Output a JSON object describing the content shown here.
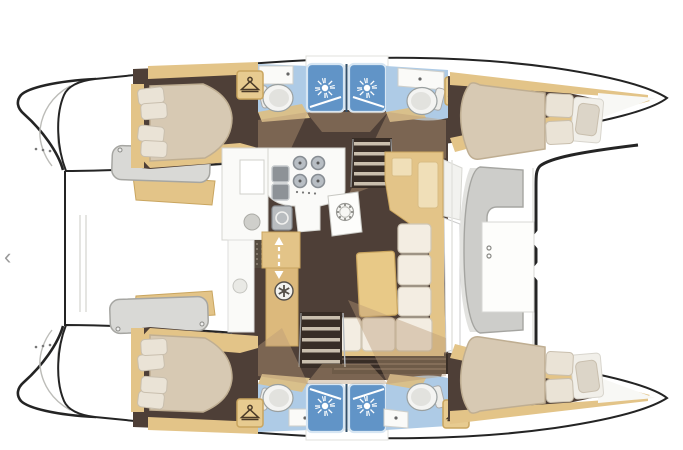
{
  "image": {
    "type": "boat-floor-plan",
    "subject": "catamaran interior deck plan, top-down view, bows to the right"
  },
  "carousel": {
    "prev_glyph": "‹"
  },
  "colors": {
    "hull_outline": "#242424",
    "wood_trim": "#e3c488",
    "wood_trim_dark": "#c9a55f",
    "wood_trim_light": "#efdcab",
    "floor_brown": "#4e3f37",
    "floor_brown_dark": "#382d26",
    "shadow_tan": "rgba(186,156,118,0.42)",
    "bed_beige": "#d7c9b3",
    "bed_stroke": "#bfae92",
    "pillow_cream": "#eae3d6",
    "bath_floor_blue": "#aecbe6",
    "shower_blue": "#6194c7",
    "shower_rim": "#d7e6f3",
    "counter_white": "#fafaf8",
    "fixture_gray": "#8d9297",
    "deck_gray": "#d9d9d6",
    "deck_stroke": "#a6a6a2",
    "chevron_gray": "#9a9a9a"
  },
  "icons": [
    {
      "name": "prev-chevron",
      "glyph": "‹"
    },
    {
      "name": "hanger-icon",
      "count": 4
    },
    {
      "name": "shower-head-icon",
      "count": 4
    },
    {
      "name": "toilet-icon",
      "count": 4
    },
    {
      "name": "sink-icon",
      "count": 4
    },
    {
      "name": "stove-burners-icon",
      "burners": 4
    },
    {
      "name": "fan-icon",
      "count": 1
    },
    {
      "name": "speaker-hatch-icon",
      "count": 1
    },
    {
      "name": "companionway-arrow-icon",
      "count": 1
    }
  ],
  "plan": {
    "cabins_with_double_beds": 4,
    "heads_with_toilet": 4,
    "shower_stalls": 4,
    "areas": [
      "saloon-sofa",
      "saloon-table",
      "galley-with-stove-and-sinks",
      "nav-desk",
      "forward-cockpit-bench",
      "foredeck-platform",
      "stern-platforms",
      "companionway-stairs-port",
      "companionway-stairs-starboard"
    ]
  }
}
